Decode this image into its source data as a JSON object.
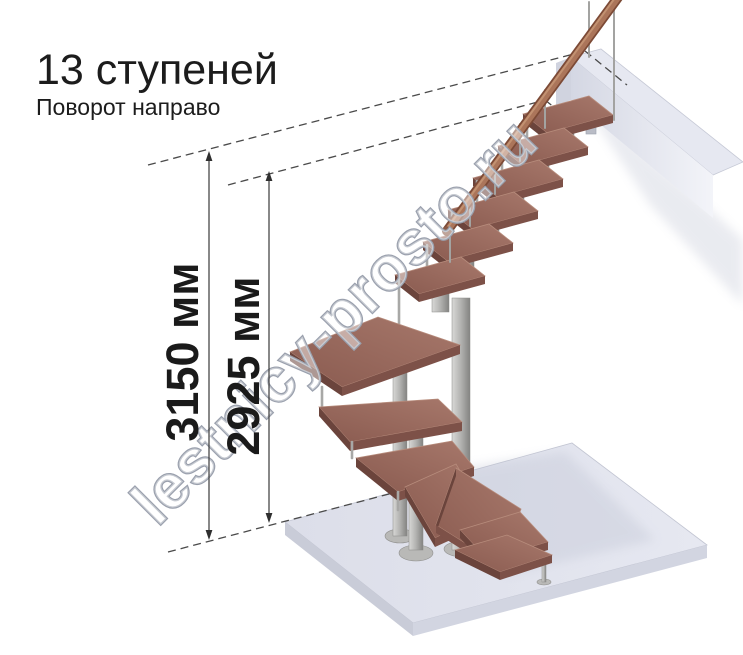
{
  "header": {
    "title": "13 ступеней",
    "subtitle": "Поворот направо"
  },
  "dimensions": [
    {
      "label": "3150 мм"
    },
    {
      "label": "2925 мм"
    }
  ],
  "watermark": {
    "text": "lestnicy-prosto.ru"
  },
  "diagram": {
    "type": "modular staircase, 3D isometric view",
    "steps_count": 13,
    "turn": "направо",
    "heights_mm": [
      3150,
      2925
    ]
  },
  "colors": {
    "background": "#ffffff",
    "text": "#1c1c1c",
    "wood_top": "#9a695c",
    "wood_face_dark": "#6b443c",
    "wood_face_mid": "#7d5148",
    "handrail": "#ab755a",
    "metal": "#b5b5b3",
    "floor_slab": "#e0e2ec",
    "beam": "#e6e8f1",
    "dimension_lines": "#3a3a3a",
    "watermark_stroke": "#9aa0ad"
  }
}
